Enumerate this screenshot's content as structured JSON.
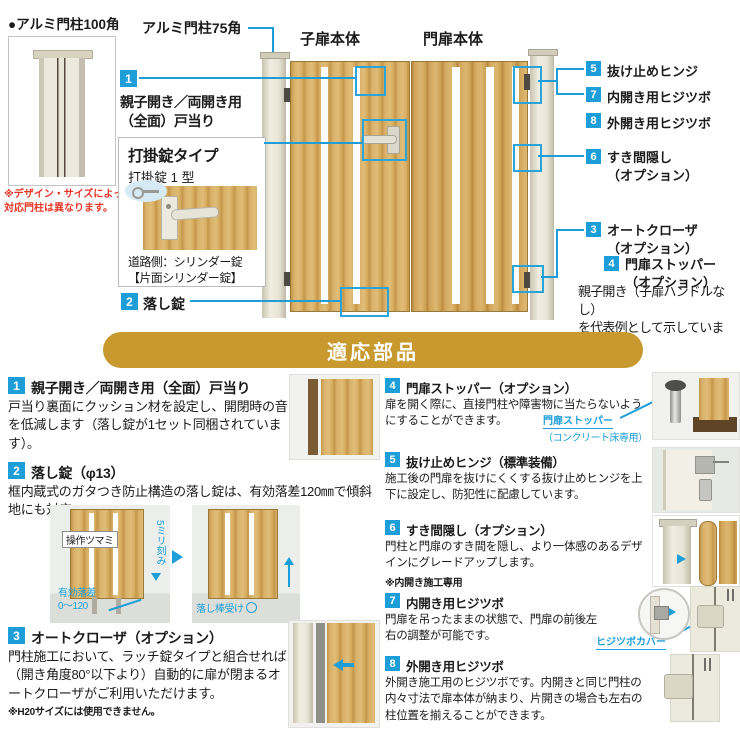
{
  "colors": {
    "accent": "#1d9ed9",
    "banner_gold": "#c7992f",
    "alert_red": "#e73828"
  },
  "diagram": {
    "post100_label": "●アルミ門柱100角",
    "post100_note_line1": "※デザイン・サイズによって",
    "post100_note_line2": "対応門柱は異なります。",
    "post75_label": "アルミ門柱75角",
    "child_door_label": "子扉本体",
    "main_door_label": "門扉本体",
    "callout1": {
      "num": "1",
      "line1": "親子開き／両開き用",
      "line2": "（全面）戸当り"
    },
    "lockbox": {
      "title": "打掛錠タイプ",
      "subtitle": "打掛錠 1 型",
      "caption_line1": "道路側：シリンダー錠",
      "caption_line2": "【片面シリンダー錠】"
    },
    "callout2": {
      "num": "2",
      "label": "落し錠"
    },
    "callout5": {
      "num": "5",
      "label": "抜け止めヒンジ"
    },
    "callout7": {
      "num": "7",
      "label": "内開き用ヒジツボ"
    },
    "callout8": {
      "num": "8",
      "label": "外開き用ヒジツボ"
    },
    "callout6": {
      "num": "6",
      "line1": "すき間隠し",
      "line2": "（オプション）"
    },
    "callout3": {
      "num": "3",
      "line1": "オートクローザ",
      "line2": "（オプション）"
    },
    "callout4": {
      "num": "4",
      "line1": "門扉ストッパー",
      "line2": "（オプション）"
    },
    "rep_note_line1": "親子開き（子扉ハンドルなし）",
    "rep_note_line2": "を代表例として示しています。"
  },
  "banner": {
    "title": "適応部品"
  },
  "parts": [
    {
      "num": "1",
      "title": "親子開き／両開き用（全面）戸当り",
      "body": "戸当り裏面にクッション材を設定し、開閉時の音を低減します（落し錠が1セット同梱されています）。"
    },
    {
      "num": "2",
      "title": "落し錠（φ13）",
      "body": "框内蔵式のガタつき防止構造の落し錠は、有効落差120㎜で傾斜地にも対応。",
      "label_knob": "操作ツマミ",
      "label_pitch": "5ミリ刻み",
      "label_drop_line1": "有効落差",
      "label_drop_line2": "0～120",
      "label_receiver": "落し棒受け"
    },
    {
      "num": "3",
      "title": "オートクローザ（オプション）",
      "body": "門柱施工において、ラッチ錠タイプと組合せれば（開き角度80°以下より）自動的に扉が閉まるオートクローザがご利用いただけます。",
      "note": "※H20サイズには使用できません。"
    },
    {
      "num": "4",
      "title": "門扉ストッパー（オプション）",
      "body": "扉を開く際に、直接門柱や障害物に当たらないようにすることができます。",
      "label_line1": "門扉ストッパー",
      "label_line2": "（コンクリート床専用）"
    },
    {
      "num": "5",
      "title": "抜け止めヒンジ（標準装備）",
      "body": "施工後の門扉を抜けにくくする抜け止めヒンジを上下に設定し、防犯性に配慮しています。"
    },
    {
      "num": "6",
      "title": "すき間隠し（オプション）",
      "body": "門柱と門扉のすき間を隠し、より一体感のあるデザインにグレードアップします。",
      "note": "※内開き施工専用"
    },
    {
      "num": "7",
      "title": "内開き用ヒジツボ",
      "body": "門扉を吊ったままの状態で、門扉の前後左右の調整が可能です。",
      "label": "ヒジツボカバー"
    },
    {
      "num": "8",
      "title": "外開き用ヒジツボ",
      "body": "外開き施工用のヒジツボです。内開きと同じ門柱の内々寸法で扉本体が納まり、片開きの場合も左右の柱位置を揃えることができます。"
    }
  ]
}
